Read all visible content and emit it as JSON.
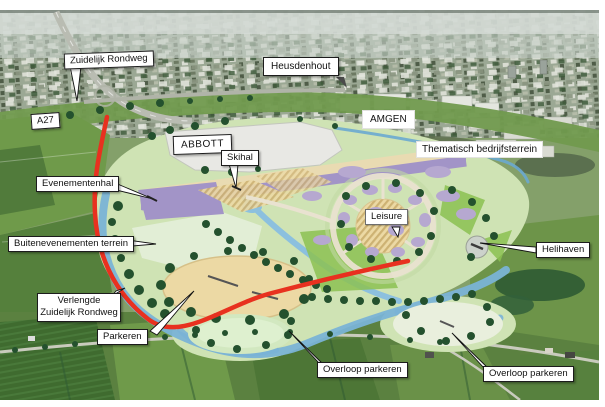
{
  "map": {
    "description": "Aerial masterplan photo with planning-zone callout labels",
    "labels": {
      "zuidelijk_rondweg": "Zuidelijk Rondweg",
      "a27": "A27",
      "heusdenhout": "Heusdenhout",
      "abbott": "ABBOTT",
      "skihal": "Skihal",
      "amgen": "AMGEN",
      "thematisch_bedrijfsterrein": "Thematisch bedrijfsterrein",
      "evenementenhal": "Evenementenhal",
      "buitenevenementen_terrein": "Buitenevenementen terrein",
      "leisure": "Leisure",
      "helihaven": "Helihaven",
      "verlengde_line1": "Verlengde",
      "verlengde_line2": "Zuidelijk Rondweg",
      "parkeren": "Parkeren",
      "overloop_parkeren_left": "Overloop parkeren",
      "overloop_parkeren_right": "Overloop parkeren"
    },
    "colors": {
      "route_red": "#e8311f",
      "water_blue": "#7ab3d6",
      "plan_green": "#cfe3b4",
      "purple_zone": "#a294c7",
      "purple_buildings": "#b6a8d0",
      "sand_tan": "#ecd9a4",
      "tree_green": "#24512e",
      "label_bg": "#ffffff",
      "label_border": "#1c1c1c"
    }
  }
}
